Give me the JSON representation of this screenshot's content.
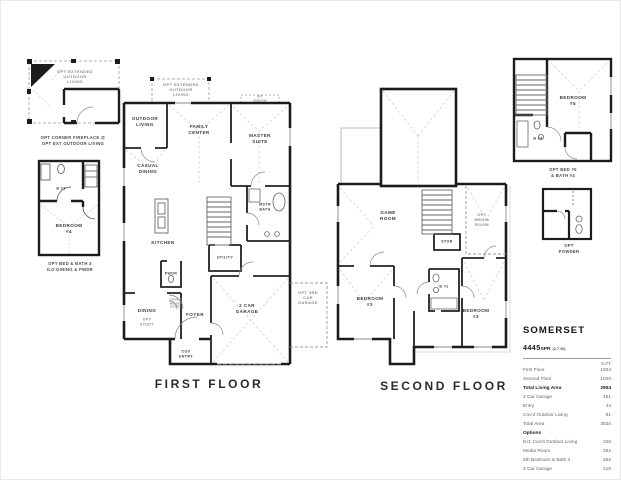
{
  "insets": {
    "fireplace": {
      "area_label": "OPT EXTENDED\nOUTDOOR\nLIVING",
      "caption": "OPT CORNER FIREPLACE @\nOPT EXT OUTDOOR LIVING"
    },
    "bed4": {
      "bath": "B #3",
      "bedroom": "BEDROOM\n#4",
      "caption": "OPT BED & BATH 3\nILO DINING & PWDR"
    },
    "bed5": {
      "bedroom": "BEDROOM\n#5",
      "bath": "B #4",
      "caption": "OPT BED #5\n& BATH #4"
    },
    "powder": {
      "caption": "OPT\nPOWDER"
    }
  },
  "first_floor": {
    "title": "FIRST FLOOR",
    "rooms": {
      "opt_extended": "OPT EXTENDED\nOUTDOOR\nLIVING",
      "outdoor_living": "OUTDOOR\nLIVING",
      "family_center": "FAMILY\nCENTER",
      "opt_window": "OPT\nWINDOW",
      "master_suite": "MASTER\nSUITE",
      "casual_dining": "CASUAL\nDINING",
      "kitchen": "KITCHEN",
      "mstr_bath": "MSTR\nBATH",
      "utility": "UTILITY",
      "pwdr": "PWDR",
      "stairs_note": "DOUBLE\nWINDER\nSTAIRS",
      "dining": "DINING",
      "opt_study": "OPT\nSTUDY",
      "foyer": "FOYER",
      "cov_entry": "COV\nENTRY",
      "garage": "2 CAR\nGARAGE",
      "opt_garage": "OPT 3RD\nCAR\nGARAGE"
    }
  },
  "second_floor": {
    "title": "SECOND FLOOR",
    "rooms": {
      "game_room": "GAME\nROOM",
      "opt_media": "OPT\nMEDIA\nROOM",
      "stor": "STOR",
      "bath2": "B #2",
      "bedroom2": "BEDROOM\n#2",
      "bedroom3": "BEDROOM\n#3"
    }
  },
  "spec_table": {
    "title": "SOMERSET",
    "model": "4445",
    "model_suffix": "SPR",
    "version": "(2.7.20)",
    "unit_header": "S.FT",
    "rows": [
      {
        "label": "First Floor",
        "value": "1934"
      },
      {
        "label": "Second Floor",
        "value": "1020"
      },
      {
        "label": "Total Living Area",
        "value": "2954"
      },
      {
        "label": "2 Car Garage",
        "value": "451"
      },
      {
        "label": "Entry",
        "value": "44"
      },
      {
        "label": "Cov'd Outdoor Living",
        "value": "81"
      },
      {
        "label": "Total Area",
        "value": "3530"
      }
    ],
    "options_label": "Options",
    "options": [
      {
        "label": "Ext. Cov'd Outdoor Living",
        "value": "228"
      },
      {
        "label": "Media Room",
        "value": "282"
      },
      {
        "label": "5th Bedroom & Bath 4",
        "value": "262"
      },
      {
        "label": "3 Car Garage",
        "value": "216"
      }
    ]
  },
  "colors": {
    "wall": "#1c1c1c",
    "optional_line": "#999999",
    "ceiling_line": "#c8c8c8"
  }
}
